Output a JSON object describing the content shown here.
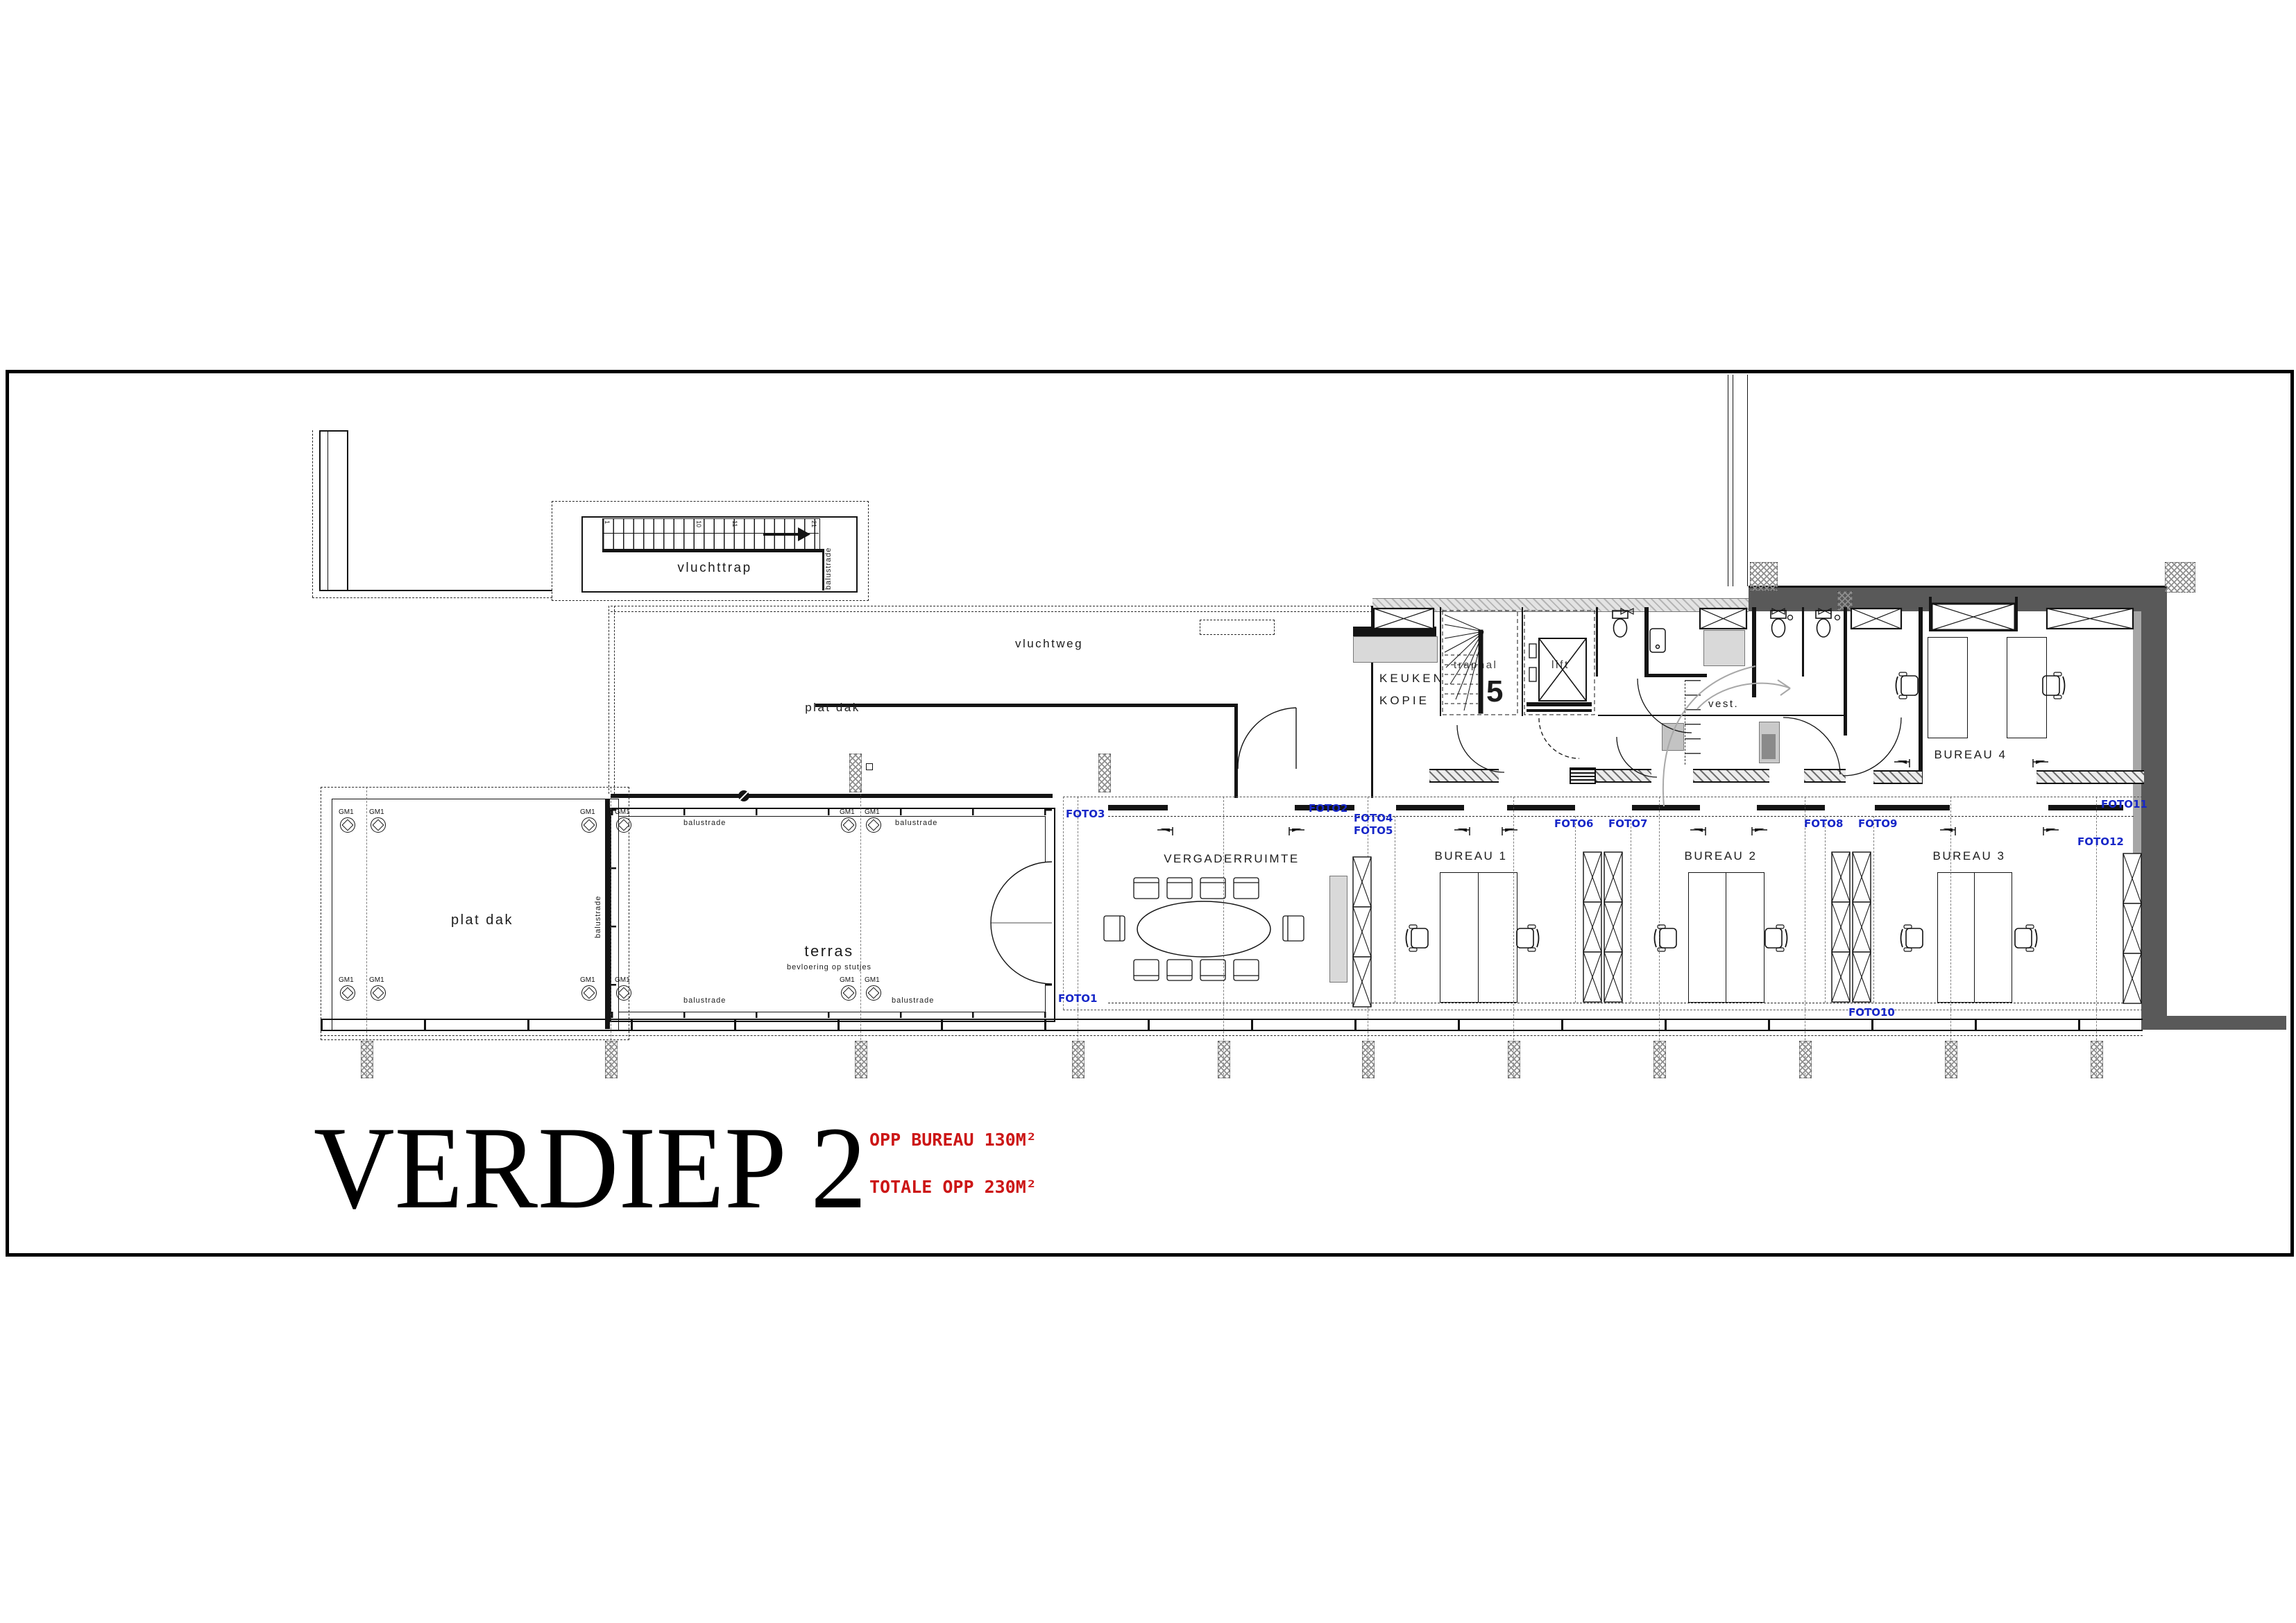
{
  "title": {
    "main": "VERDIEP 2",
    "note1": "OPP BUREAU 130M²",
    "note2": "TOTALE OPP 230M²"
  },
  "rooms": {
    "vluchttrap": "vluchttrap",
    "vluchtweg": "vluchtweg",
    "plat_dak_wing": "plat dak",
    "plat_dak_left": "plat dak",
    "terras": "terras",
    "terras_sub": "bevloering op stutjes",
    "vergaderruimte": "VERGADERRUIMTE",
    "bureau1": "BUREAU 1",
    "bureau2": "BUREAU 2",
    "bureau3": "BUREAU 3",
    "bureau4": "BUREAU 4",
    "keuken1": "KEUKEN",
    "keuken2": "KOPIE",
    "traphal": "traphal",
    "lift": "lift",
    "vest": "vest."
  },
  "annotations": {
    "balustrade": "balustrade",
    "gm1": "GM1",
    "stair_first": "1",
    "stair_n10": "10",
    "stair_n11": "11",
    "stair_n21": "21",
    "stair_count": "5"
  },
  "fotos": [
    "FOTO1",
    "FOTO2",
    "FOTO3",
    "FOTO4",
    "FOTO5",
    "FOTO6",
    "FOTO7",
    "FOTO8",
    "FOTO9",
    "FOTO10",
    "FOTO11",
    "FOTO12"
  ],
  "colors": {
    "foto_blue": "#1727c8",
    "note_red": "#cc1616",
    "wall_dark": "#595959",
    "wall_mid": "#a6a6a6"
  }
}
